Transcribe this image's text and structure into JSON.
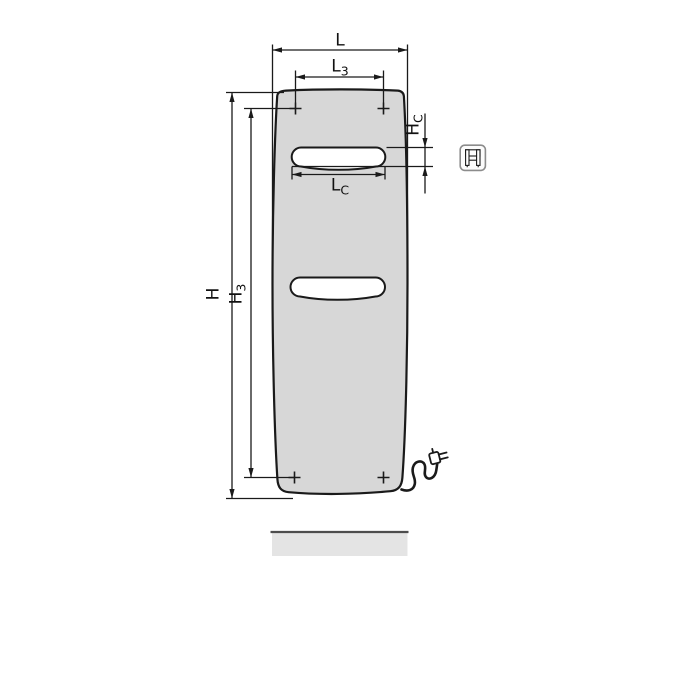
{
  "drawing": {
    "type": "technical dimensional drawing",
    "subject": "flat panel bathroom radiator, front view, electric version with power cord and floor line",
    "dimension_labels": {
      "L": {
        "base": "L",
        "sub": ""
      },
      "L3": {
        "base": "L",
        "sub": "3"
      },
      "LC": {
        "base": "L",
        "sub": "C"
      },
      "H": {
        "base": "H",
        "sub": ""
      },
      "H3": {
        "base": "H",
        "sub": "3"
      },
      "HC": {
        "base": "H",
        "sub": "C"
      }
    },
    "icons": {
      "electric-connection-icon": "rounded square pictogram of radiator with electric element",
      "power-plug-icon": "power cord ending in mains plug",
      "mounting-point-icon": "+ cross marking wall-bracket fixing point"
    },
    "colors": {
      "line": "#1a1a1a",
      "panel_fill": "#d7d7d7",
      "slot_fill": "#ffffff",
      "floor_fill": "#e4e4e4",
      "floor_edge": "#4d4d4d",
      "icon_border": "#8c8c8c",
      "background": "#ffffff"
    }
  }
}
